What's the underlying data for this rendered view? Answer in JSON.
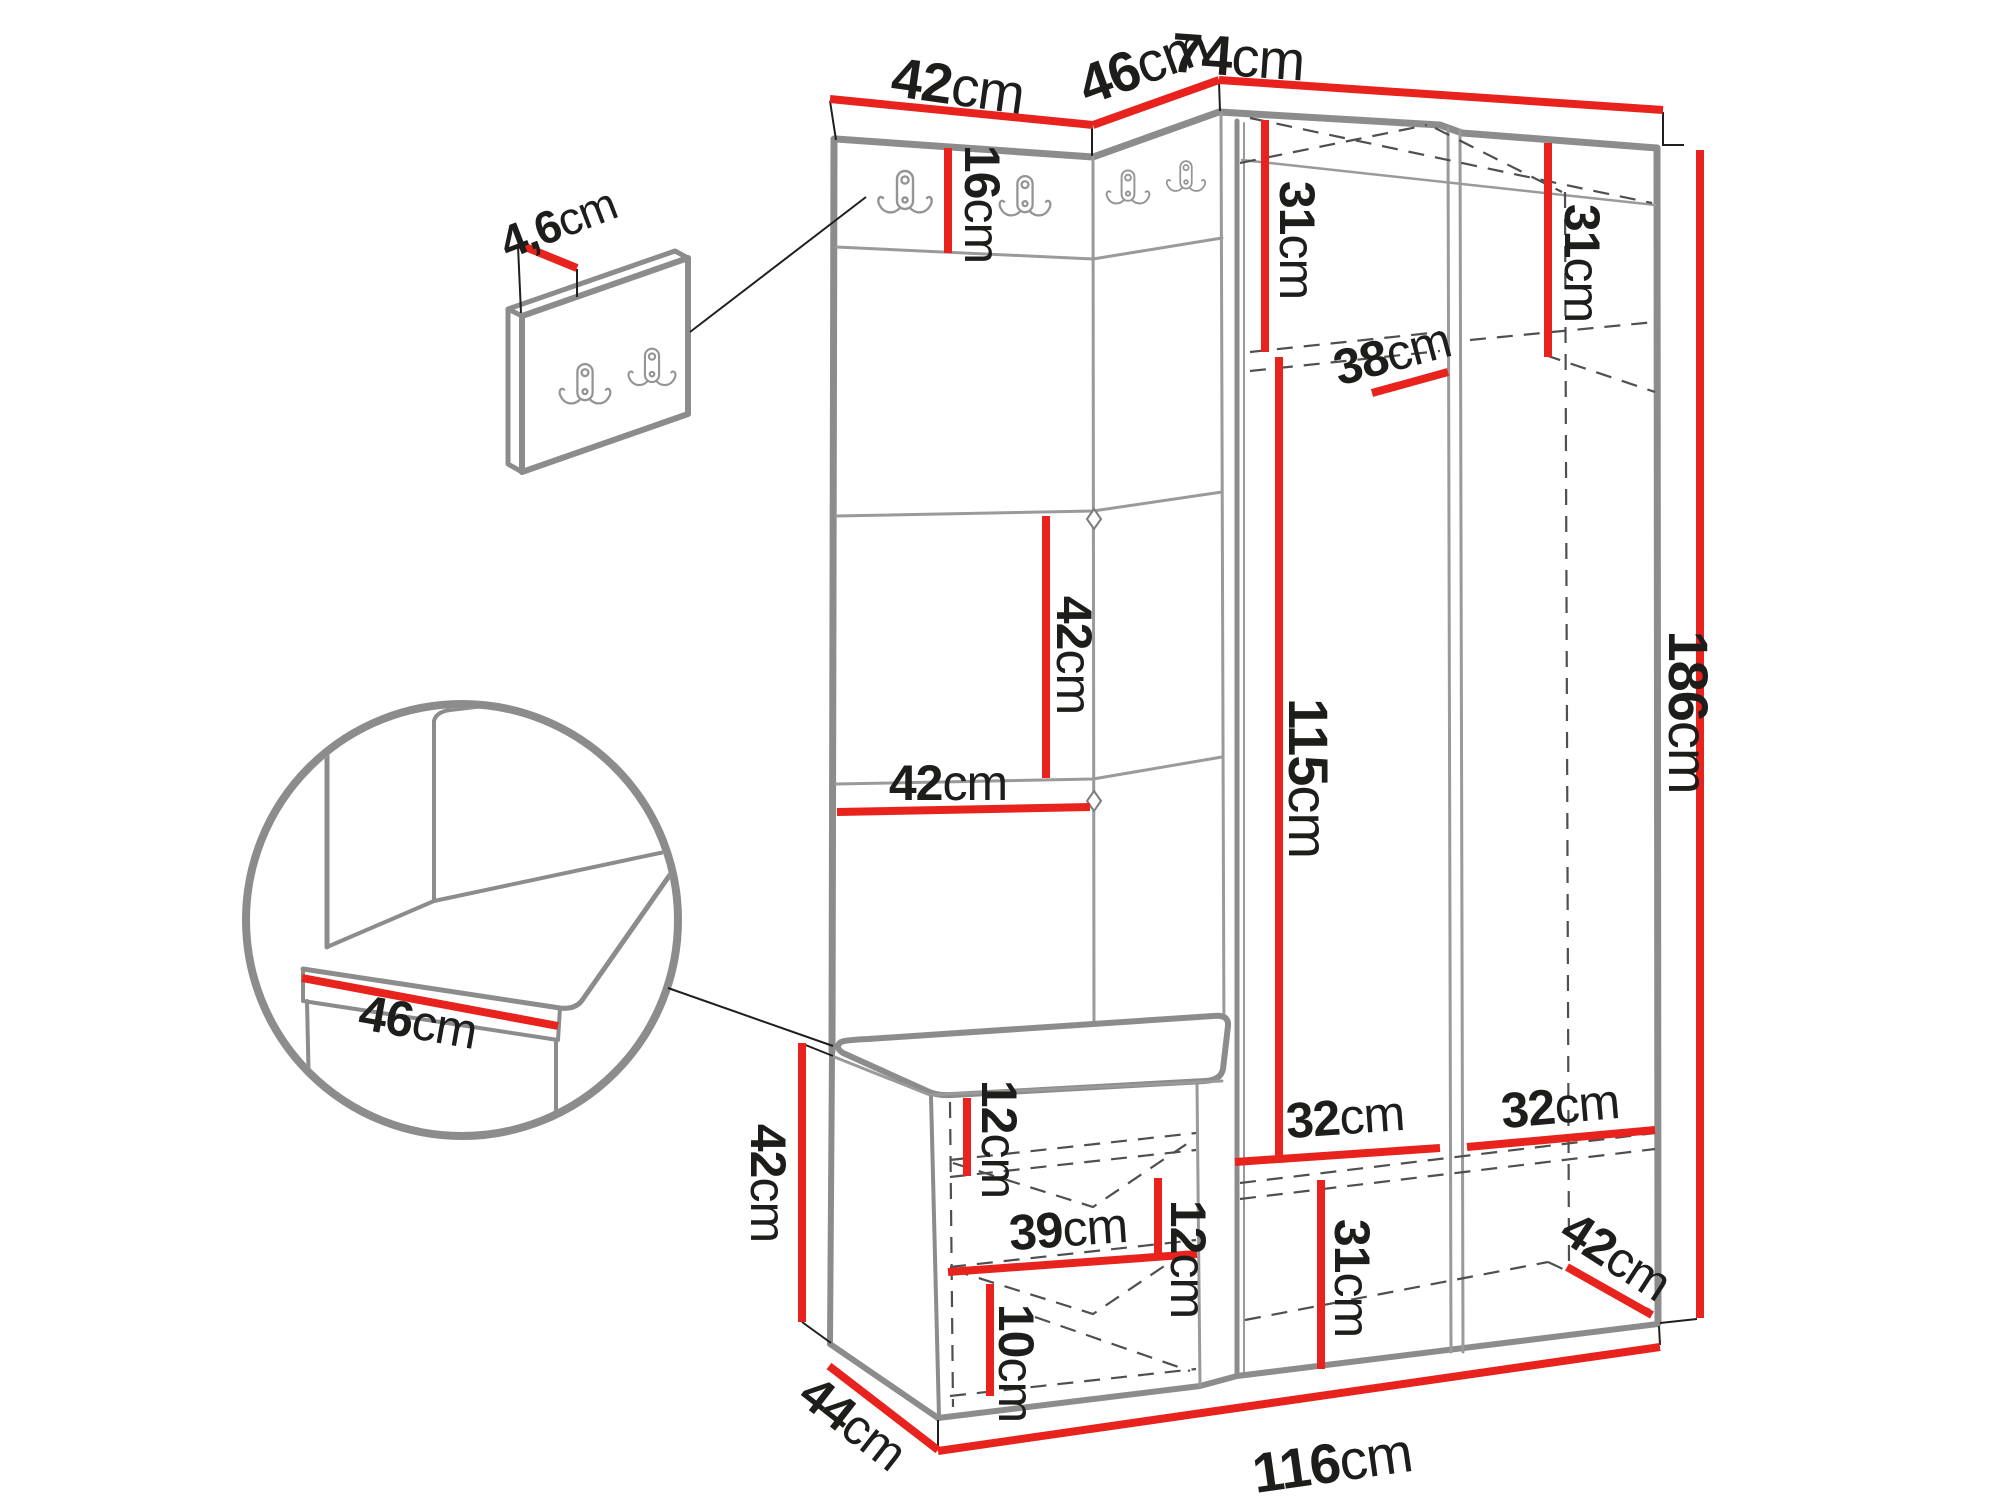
{
  "colors": {
    "dimension_line": "#e8231d",
    "furniture_outline": "#8c8c8c",
    "hidden_edge": "#4f4f4f",
    "label_text": "#1d1d1b",
    "background": "#ffffff"
  },
  "icons": {
    "coat_hook": "double-coat-hook"
  },
  "dimensions": {
    "panel_top_width": {
      "value": "42",
      "unit": "cm"
    },
    "corner_top_width": {
      "value": "46",
      "unit": "cm"
    },
    "wardrobe_top_width": {
      "value": "74",
      "unit": "cm"
    },
    "hook_board_thickness": {
      "value": "4,6",
      "unit": "cm"
    },
    "hook_strip_height": {
      "value": "16",
      "unit": "cm"
    },
    "left_top_shelf_height": {
      "value": "31",
      "unit": "cm"
    },
    "right_top_shelf_height": {
      "value": "31",
      "unit": "cm"
    },
    "top_shelf_depth": {
      "value": "38",
      "unit": "cm"
    },
    "panel_tile_height": {
      "value": "42",
      "unit": "cm"
    },
    "panel_front_width": {
      "value": "42",
      "unit": "cm"
    },
    "hanging_space_height": {
      "value": "115",
      "unit": "cm"
    },
    "total_height": {
      "value": "186",
      "unit": "cm"
    },
    "seat_detail_width": {
      "value": "46",
      "unit": "cm"
    },
    "seat_shelf_offset": {
      "value": "12",
      "unit": "cm"
    },
    "bench_inner_width": {
      "value": "39",
      "unit": "cm"
    },
    "bench_shelf_gap": {
      "value": "12",
      "unit": "cm"
    },
    "bench_bottom_height": {
      "value": "10",
      "unit": "cm"
    },
    "bench_height": {
      "value": "42",
      "unit": "cm"
    },
    "bench_depth": {
      "value": "44",
      "unit": "cm"
    },
    "bottom_left_inner_width": {
      "value": "32",
      "unit": "cm"
    },
    "bottom_right_inner_width": {
      "value": "32",
      "unit": "cm"
    },
    "bottom_section_height": {
      "value": "31",
      "unit": "cm"
    },
    "wardrobe_depth": {
      "value": "42",
      "unit": "cm"
    },
    "total_width": {
      "value": "116",
      "unit": "cm"
    }
  }
}
